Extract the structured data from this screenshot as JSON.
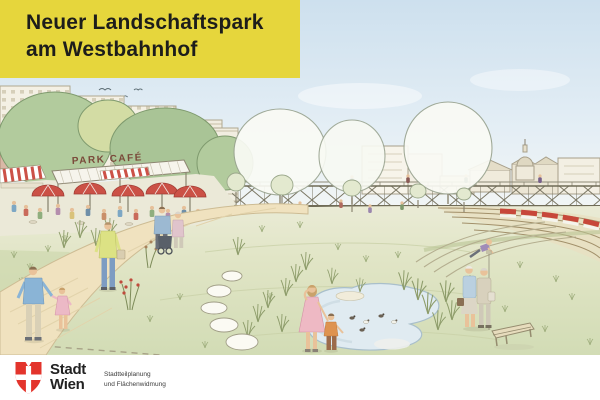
{
  "banner": {
    "title_line1": "Neuer Landschaftspark",
    "title_line2": "am Westbahnhof"
  },
  "illustration": {
    "park_cafe_sign": "PARK CAFÉ"
  },
  "footer": {
    "logo_line1": "Stadt",
    "logo_line2": "Wien",
    "department_line1": "Stadtteilplanung",
    "department_line2": "und Flächenwidmung"
  },
  "colors": {
    "banner_yellow": "#e6d63c",
    "title_text": "#1d1d1b",
    "stadt_wien_red": "#e3342c",
    "sky_blue": "#cfe1ee",
    "grass_green": "#dbe1c0",
    "path_tan": "#f0e2bf",
    "tree_green": "#afc99b",
    "umbrella_red": "#cb5146",
    "pond_blue": "#e0ebf1",
    "train_red": "#c7473a"
  }
}
